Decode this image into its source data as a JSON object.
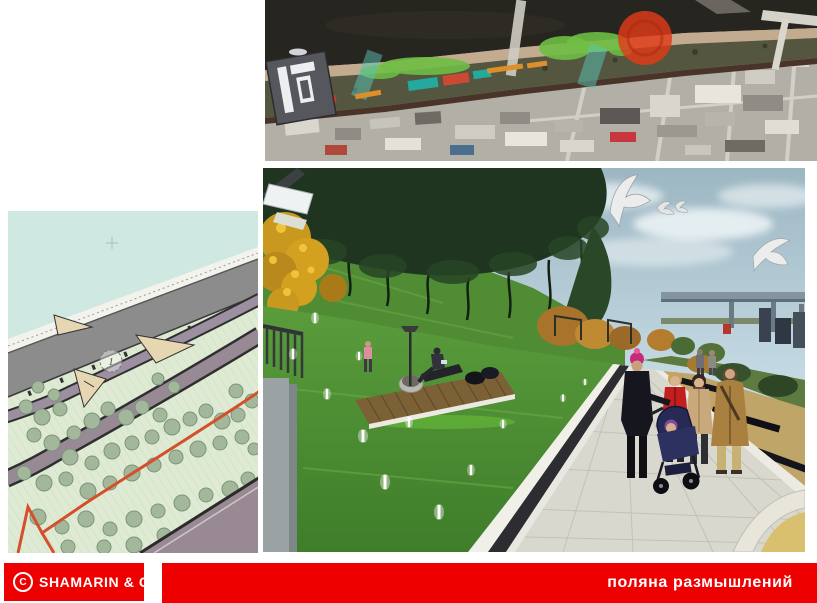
{
  "slide": {
    "background_color": "#ffffff",
    "accent_red": "#ee0000"
  },
  "footer": {
    "brand_symbol": "C",
    "brand_name": "SHAMARIN & C",
    "title": "поляна размышлений",
    "bar_color": "#ee0000",
    "text_color": "#ffffff"
  },
  "aerial_map": {
    "description": "satellite view of riverside site with masterplan overlays",
    "marker_color": "#e23b17",
    "overlay_green": "#6fbe44",
    "overlay_teal": "#59c4b6",
    "water_color": "#27251f"
  },
  "site_plan": {
    "description": "landscape site plan of embankment park",
    "area_label": "1",
    "water_color": "#cfe8e1",
    "park_color": "#deead3",
    "embankment_color": "#8c8c8c",
    "boundary_color": "#d4502c"
  },
  "render": {
    "description": "perspective render of park promenade with lawn, trees, deck and people"
  }
}
